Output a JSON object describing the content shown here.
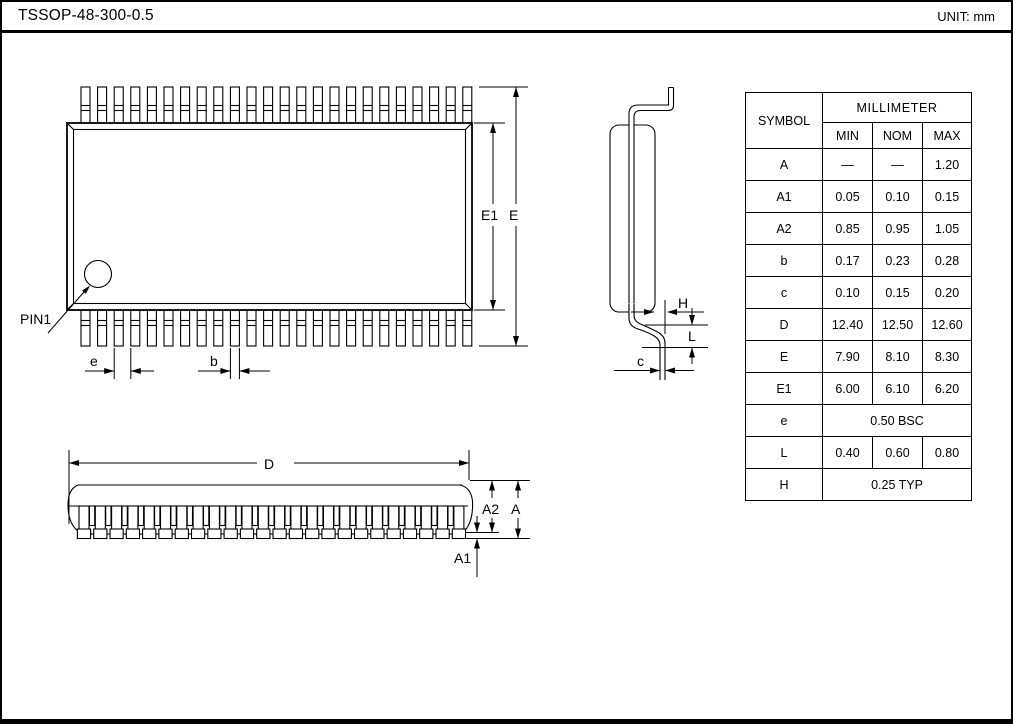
{
  "title_bar": {
    "title": "TSSOP-48-300-0.5",
    "unit_label": "UNIT: mm"
  },
  "drawing": {
    "pins_per_side": 24,
    "front_leads": 24,
    "labels": {
      "pin1": "PIN1",
      "e1": "E1",
      "e_overall": "E",
      "pitch": "e",
      "lead_width": "b",
      "h": "H",
      "l": "L",
      "c": "c",
      "d": "D",
      "a2": "A2",
      "a": "A",
      "a1": "A1"
    }
  },
  "table": {
    "symbol_header": "SYMBOL",
    "unit_group_header": "MILLIMETER",
    "col_headers": [
      "MIN",
      "NOM",
      "MAX"
    ],
    "rows": [
      {
        "symbol": "A",
        "min": "—",
        "nom": "—",
        "max": "1.20"
      },
      {
        "symbol": "A1",
        "min": "0.05",
        "nom": "0.10",
        "max": "0.15"
      },
      {
        "symbol": "A2",
        "min": "0.85",
        "nom": "0.95",
        "max": "1.05"
      },
      {
        "symbol": "b",
        "min": "0.17",
        "nom": "0.23",
        "max": "0.28"
      },
      {
        "symbol": "c",
        "min": "0.10",
        "nom": "0.15",
        "max": "0.20"
      },
      {
        "symbol": "D",
        "min": "12.40",
        "nom": "12.50",
        "max": "12.60"
      },
      {
        "symbol": "E",
        "min": "7.90",
        "nom": "8.10",
        "max": "8.30"
      },
      {
        "symbol": "E1",
        "min": "6.00",
        "nom": "6.10",
        "max": "6.20"
      },
      {
        "symbol": "e",
        "span": "0.50 BSC"
      },
      {
        "symbol": "L",
        "min": "0.40",
        "nom": "0.60",
        "max": "0.80"
      },
      {
        "symbol": "H",
        "span": "0.25 TYP"
      }
    ]
  },
  "colors": {
    "line": "#000000",
    "background": "#ffffff"
  }
}
